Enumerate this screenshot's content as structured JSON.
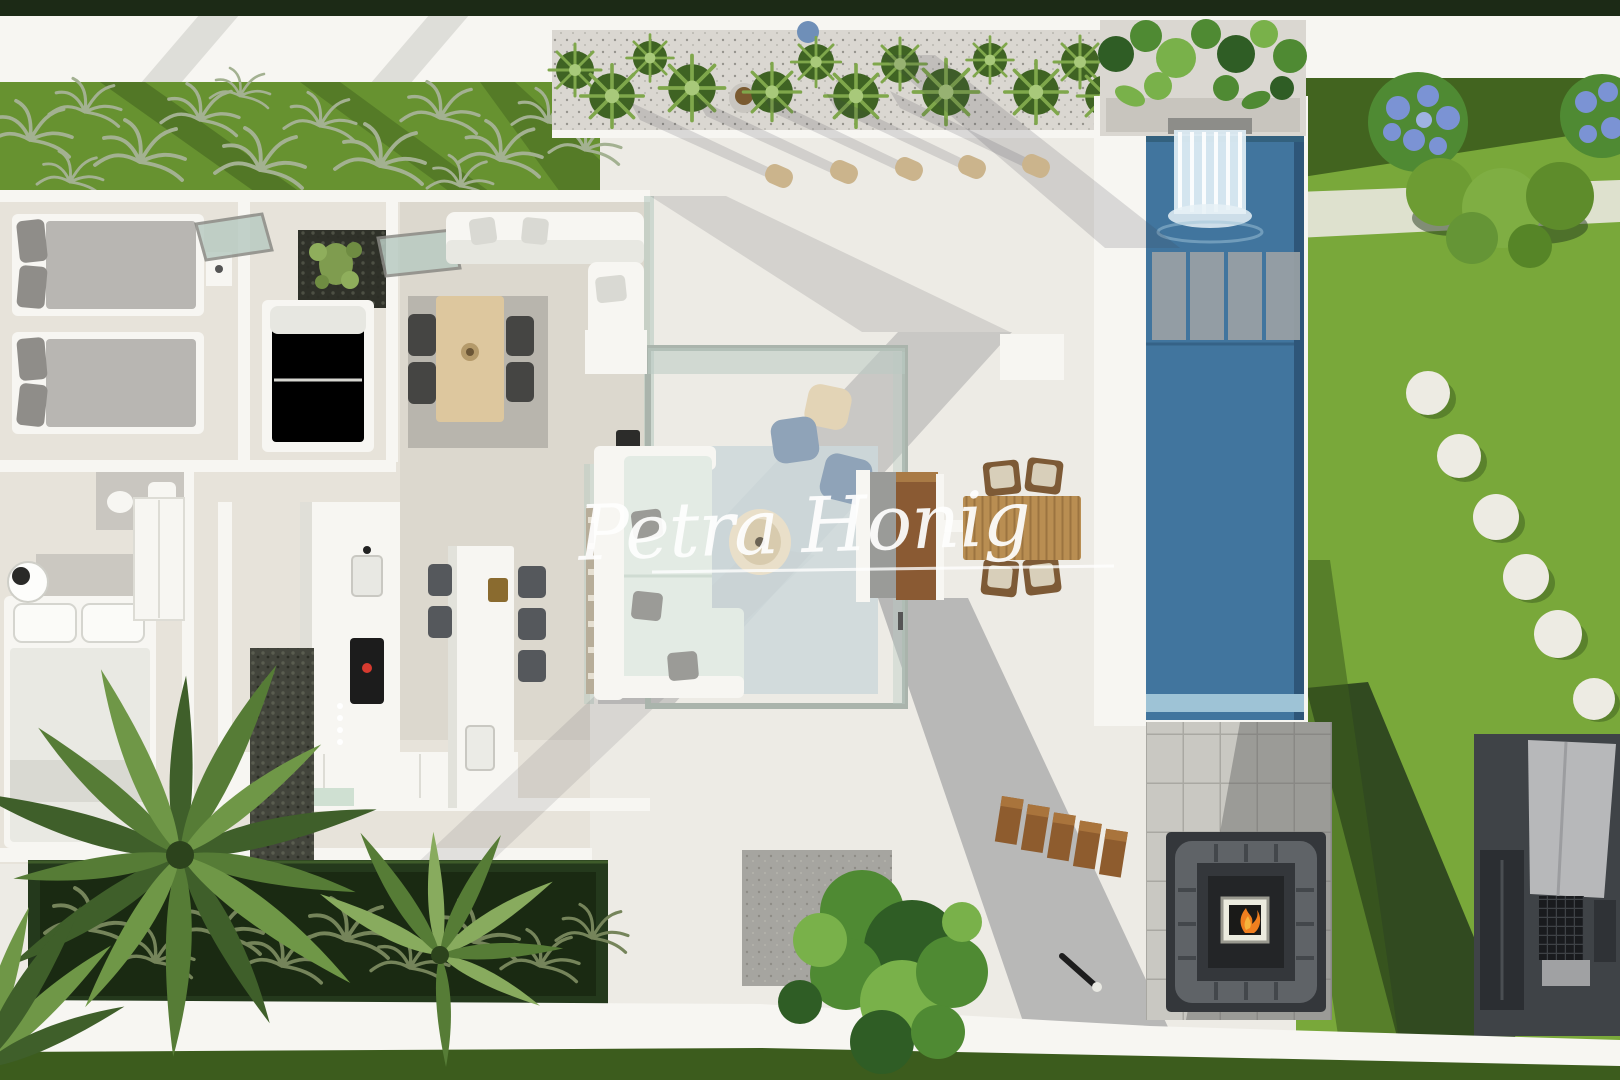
{
  "meta": {
    "image_type": "photorealistic 3d architectural render",
    "view": "top-down aerial view of a modern villa plot",
    "subject": "open-roof villa floor plan with covered terrace, swimming pool, lawn and outdoor lounge"
  },
  "watermark": {
    "text": "Petra Honig",
    "style": "white handwritten script",
    "color": "#ffffff",
    "underline": true
  },
  "palette": {
    "wall-white": "#f7f6f2",
    "terrace": "#edebe5",
    "floor": "#e7e3da",
    "hedge-dark": "#1c2a16",
    "grass-left": "#679230",
    "grass-bright": "#79a83a",
    "grass-dark": "#3c5c1d",
    "grass-deep": "#24391c",
    "pool": "#41759e",
    "pool-light": "#9ec3d6",
    "pool-slab": "#9aa1a5",
    "planter-stone": "#dad7d1",
    "wood": "#b98e52",
    "wood-dark": "#8e5c2e",
    "wood-light": "#ddc79e",
    "sofa-mint": "#e3ebe4",
    "gravel": "#a6a5a0",
    "platform": "#c9c8c2",
    "pit-dark": "#34373b",
    "pit-cushion": "#5f6367",
    "bbq-dark": "#3f4347",
    "bbq-panel": "#b7b8ba",
    "glass": "#b9cbc2",
    "stool-dark": "#55585c",
    "chair-dark": "#454543",
    "pouf-blue": "#8fa3b8",
    "pouf-cream": "#e3d4b6",
    "bolster": "#cbb48c",
    "leaf-dark": "#2f5d25",
    "leaf-mid": "#4f8a33",
    "leaf-light": "#79b14a",
    "hydrangea": "#7b93d4",
    "fire-orange": "#f07f1f",
    "fire-yellow": "#f6b43c",
    "rug-gray": "#b4b1aa",
    "rug-blue": "#cdd8db",
    "cushion-gray": "#9b9b97"
  },
  "scene": {
    "areas": [
      "boundary-hedge",
      "boundary-wall",
      "ornamental-grass-bed",
      "roof-planter-strip",
      "bedroom-two-single-beds",
      "study-bedroom-daybed",
      "cactus-courtyard",
      "indoor-dining",
      "indoor-living",
      "master-bedroom",
      "kitchen",
      "kitchen-island",
      "pebble-courtyard",
      "glass-pergola-lounge",
      "outdoor-dining",
      "swimming-pool",
      "pool-waterfall",
      "pool-sun-shelf",
      "lawn-with-stepping-stones",
      "sunken-fire-pit-lounge",
      "outdoor-kitchen-bbq",
      "palm-garden-bed",
      "garden-tree",
      "wooden-steps",
      "perimeter-walkway"
    ],
    "counts": {
      "sun-bolsters": 5,
      "stepping-stones": 6,
      "bar-stools": 5,
      "indoor-dining-chairs": 4,
      "outdoor-dining-chairs": 4,
      "pool-sun-shelf-slabs": 4,
      "wooden-steps": 5,
      "single-beds": 2
    }
  }
}
